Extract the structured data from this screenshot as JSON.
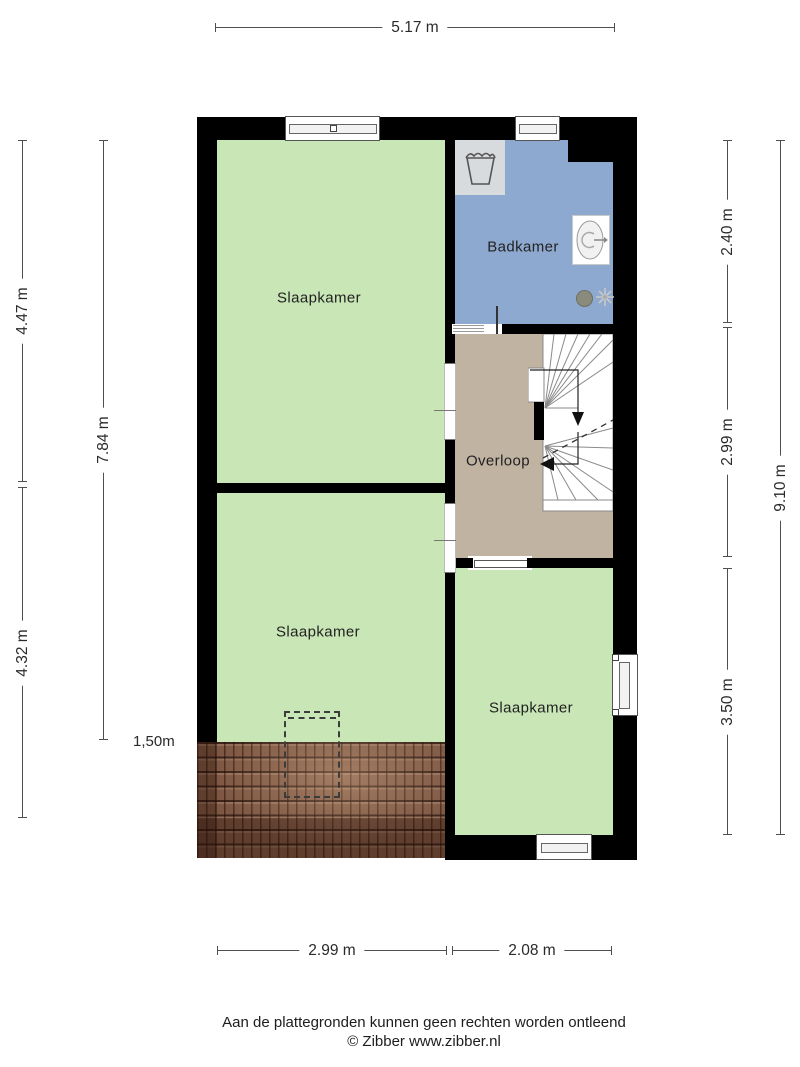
{
  "footer": {
    "disclaimer": "Aan de plattegronden kunnen geen rechten worden ontleend",
    "copyright": "© Zibber www.zibber.nl"
  },
  "rooms": {
    "bedroom_top": {
      "label": "Slaapkamer"
    },
    "bathroom": {
      "label": "Badkamer"
    },
    "landing": {
      "label": "Overloop"
    },
    "bedroom_middle": {
      "label": "Slaapkamer"
    },
    "bedroom_bottom": {
      "label": "Slaapkamer"
    }
  },
  "dimensions": {
    "top_width": "5.17 m",
    "left_top": "4.47 m",
    "left_bottom": "4.32 m",
    "left_total": "7.84 m",
    "right_bathroom": "2.40 m",
    "right_landing": "2.99 m",
    "right_bedroom": "3.50 m",
    "right_total": "9.10 m",
    "bottom_left": "2.99 m",
    "bottom_right": "2.08 m",
    "knee_wall_height": "1,50m"
  },
  "colors": {
    "page_bg": "#ffffff",
    "wall": "#000000",
    "bedroom_floor": "#c9e6b6",
    "bathroom_floor": "#8ea9cf",
    "landing_floor": "#c1b3a2",
    "roof_tiles": "#7d5743",
    "appliance": "#d8dbde",
    "dimension_line": "#4f4f4f"
  }
}
